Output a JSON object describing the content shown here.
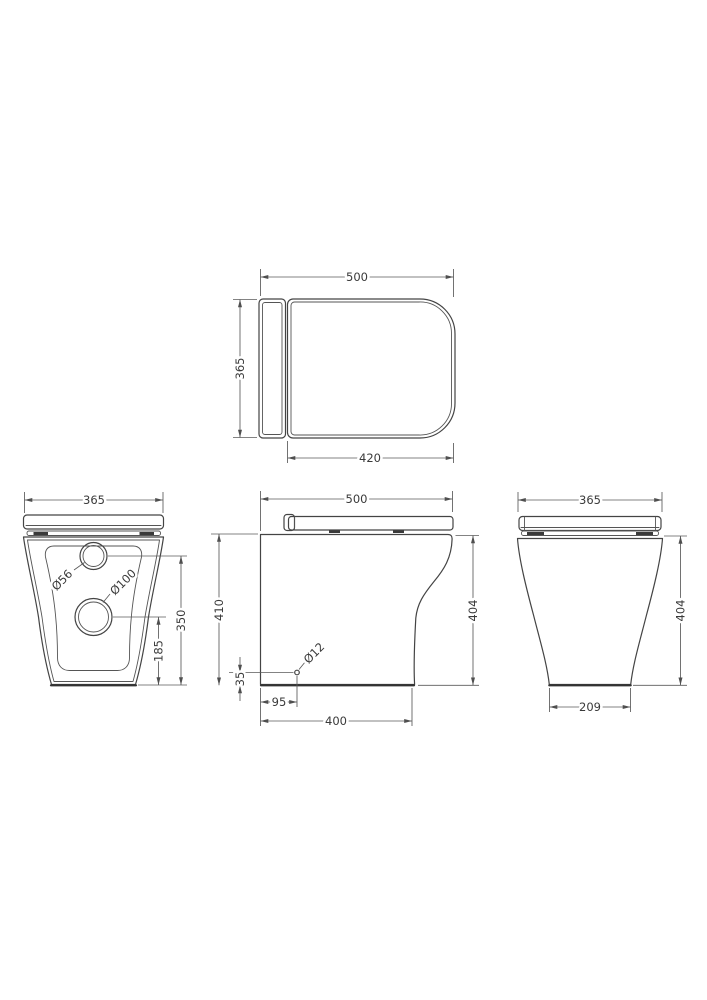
{
  "drawing": {
    "colors": {
      "background": "#ffffff",
      "product_line": "#444444",
      "dimension_line": "#5a5a5a",
      "text": "#3a3a3a"
    },
    "views": {
      "top": {
        "overall_width": "500",
        "overall_depth": "365",
        "seat_depth": "420"
      },
      "back": {
        "overall_width": "365",
        "inlet_hole_diameter": "Ø56",
        "outlet_hole_diameter": "Ø100",
        "inlet_center_from_floor": "350",
        "outlet_center_from_floor": "185"
      },
      "side": {
        "overall_depth": "500",
        "pan_height_rear": "410",
        "pan_height_front": "404",
        "fixing_hole_diameter": "Ø12",
        "fixing_hole_height": "35",
        "fixing_hole_setback": "95",
        "base_depth": "400"
      },
      "front": {
        "overall_width": "365",
        "pan_height": "404",
        "base_width": "209"
      }
    }
  }
}
